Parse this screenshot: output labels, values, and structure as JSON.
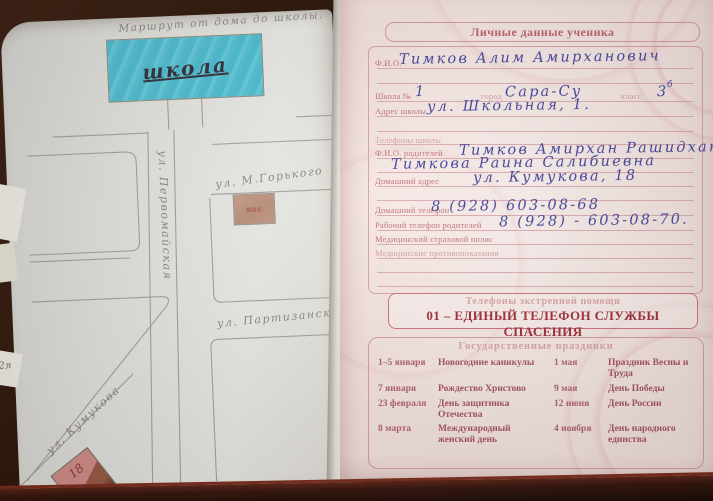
{
  "left_page": {
    "title": "Маршрут от дома до школы.",
    "school_label": "школа",
    "streets": {
      "vertical": "ул. Первомайская",
      "gorky": "ул. М.Горького",
      "partizanskaya": "ул. Партизанская",
      "kumukova": "ул. Кумукова"
    },
    "shop_label": "маг.",
    "house_number": "18",
    "edge_note": "2я"
  },
  "right_page": {
    "header": "Личные данные ученика",
    "form": {
      "fio_label": "Ф.И.О.",
      "fio_value": "Тимков Алим Амирханович",
      "school_label": "Школа №",
      "school_value": "1",
      "city_label": "город",
      "city_value": "Сара-Су",
      "class_label": "класс",
      "class_value": "3",
      "class_sup": "б",
      "school_address_label": "Адрес школы",
      "school_address_value": "ул. Школьная, 1.",
      "school_phones_label": "Телефоны школы",
      "parents_label": "Ф.И.О. родителей",
      "parents_value_1": "Тимков Амирхан Рашидхан.",
      "parents_value_2": "Тимкова Раина Салибиевна",
      "home_address_label": "Домашний адрес",
      "home_address_value": "ул. Кумукова, 18",
      "home_phone_label": "Домашний телефон",
      "home_phone_value": "8 (928) 603-08-68",
      "work_phone_label": "Рабочий телефон родителей",
      "work_phone_value": "8 (928) - 603-08-70.",
      "med_policy_label": "Медицинский страховой полис",
      "med_contra_label": "Медицинские противопоказания"
    },
    "emergency": {
      "header": "Телефоны экстренной помощи",
      "line": "01 – ЕДИНЫЙ ТЕЛЕФОН СЛУЖБЫ СПАСЕНИЯ"
    },
    "holidays": {
      "header": "Государственные праздники",
      "rows": [
        {
          "d1": "1–5 января",
          "h1": "Новогодние каникулы",
          "d2": "1 мая",
          "h2": "Праздник Весны и Труда"
        },
        {
          "d1": "7 января",
          "h1": "Рождество Христово",
          "d2": "9 мая",
          "h2": "День Победы"
        },
        {
          "d1": "23 февраля",
          "h1": "День защитника Отечества",
          "d2": "12 июня",
          "h2": "День России"
        },
        {
          "d1": "8 марта",
          "h1": "Международный женский день",
          "d2": "4 ноября",
          "h2": "День народного единства"
        }
      ]
    }
  },
  "colors": {
    "ink_blue": "#4547a0",
    "print_pink": "#c5737e",
    "print_red": "#a12f3c",
    "pencil_gray": "#82827b",
    "school_fill": "#52c5d8"
  }
}
